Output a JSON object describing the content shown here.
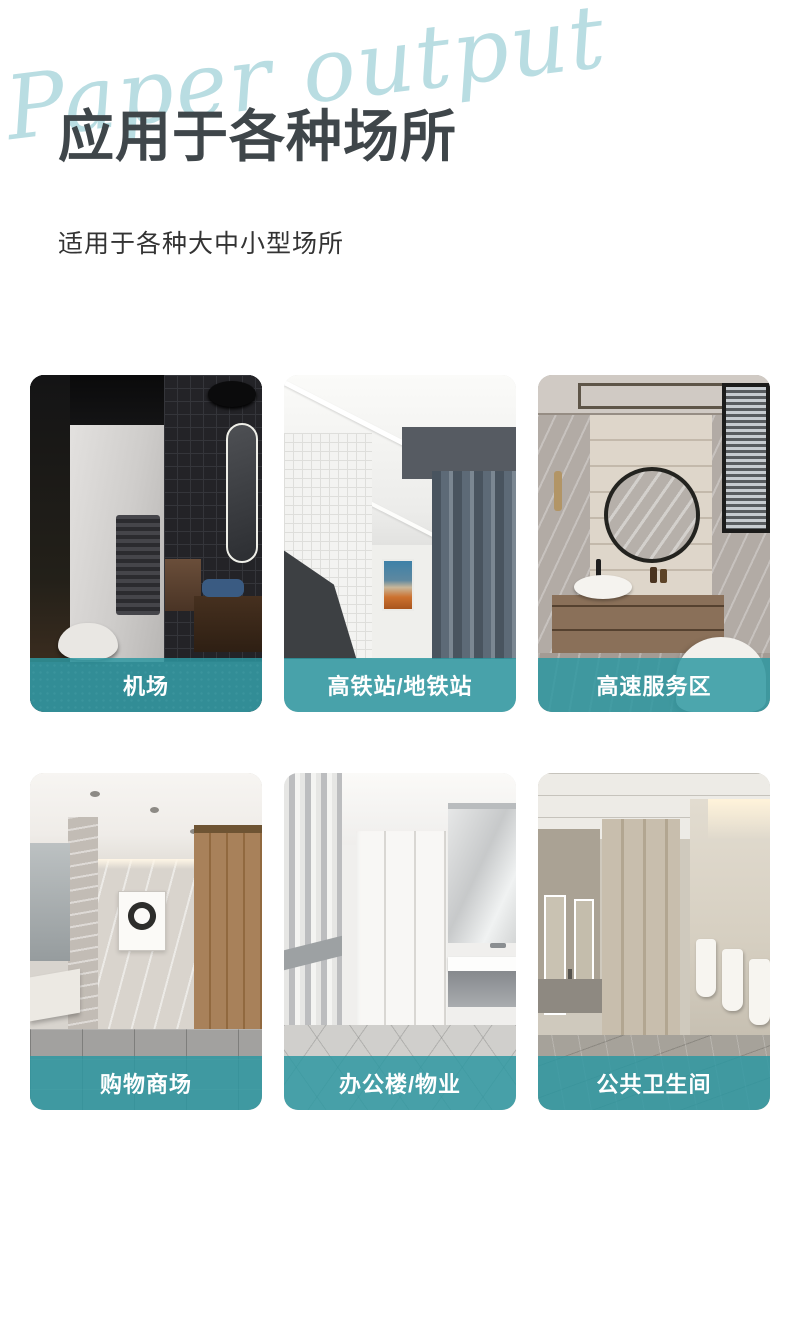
{
  "header": {
    "script_text": "Paper output",
    "title": "应用于各种场所",
    "subtitle": "适用于各种大中小型场所"
  },
  "theme": {
    "accent_teal": "#2c97a1",
    "banner_overlay": "rgba(44,151,161,0.84)",
    "title_color": "#3f464a",
    "script_color": "#b9dde2",
    "background": "#ffffff"
  },
  "cards": [
    {
      "label": "机场",
      "scene": "airport-dark-restroom"
    },
    {
      "label": "高铁站/地铁站",
      "scene": "rail-subway-station-restroom"
    },
    {
      "label": "高速服务区",
      "scene": "highway-service-area-restroom"
    },
    {
      "label": "购物商场",
      "scene": "shopping-mall-restroom"
    },
    {
      "label": "办公楼/物业",
      "scene": "office-property-restroom"
    },
    {
      "label": "公共卫生间",
      "scene": "public-restroom"
    }
  ]
}
